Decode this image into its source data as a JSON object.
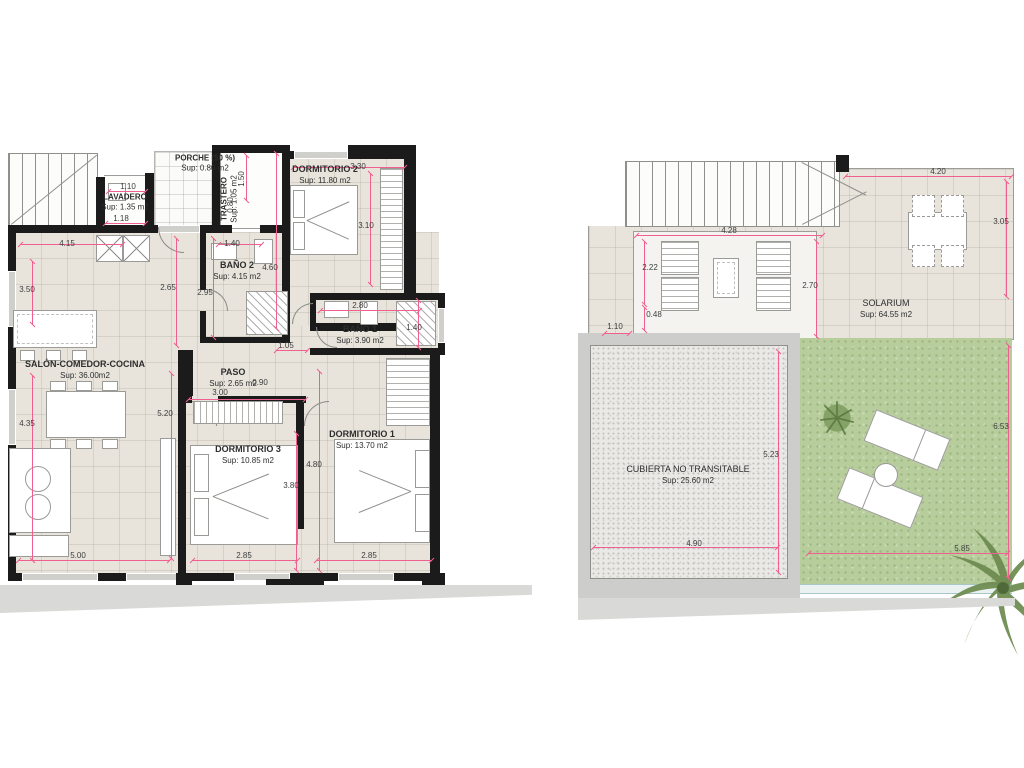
{
  "colors": {
    "accent_pink": "#ef5f90",
    "wall_black": "#1b1b1b",
    "floor_tile": "#e8e4dc",
    "grass_green": "#b7cd9c",
    "gravel_gray": "#eae9e5",
    "slab_gray": "#cdcdcb"
  },
  "left_plan": {
    "title": "apartment floor plan",
    "rooms": {
      "porche": {
        "label": "PORCHE (50 %)",
        "sup": "Sup: 0.80 m2"
      },
      "lavadero": {
        "label": "LAVADERO",
        "sup": "Sup: 1.35 m2"
      },
      "trastero": {
        "label": "TRASTERO",
        "sup": "Sup: 1.05 m2"
      },
      "dormitorio2": {
        "label": "DORMITORIO 2",
        "sup": "Sup: 11.80 m2"
      },
      "bano2": {
        "label": "BAÑO 2",
        "sup": "Sup: 4.15 m2"
      },
      "bano1": {
        "label": "BAÑO 1",
        "sup": "Sup: 3.90 m2"
      },
      "salon": {
        "label": "SALÓN-COMEDOR-COCINA",
        "sup": "Sup: 36.00m2"
      },
      "paso": {
        "label": "PASO",
        "sup": "Sup: 2.65 m2"
      },
      "dormitorio3": {
        "label": "DORMITORIO 3",
        "sup": "Sup: 10.85 m2"
      },
      "dormitorio1": {
        "label": "DORMITORIO 1",
        "sup": "Sup: 13.70 m2"
      }
    },
    "dims": {
      "d110": "1.10",
      "d118": "1.18",
      "d150": "1.50",
      "d080": "0.80",
      "d330": "3.30",
      "d310": "3.10",
      "d460": "4.60",
      "d415": "4.15",
      "d350": "3.50",
      "d265": "2.65",
      "d295": "2.95",
      "d140a": "1.40",
      "d280": "2.80",
      "d140b": "1.40",
      "d105": "1.05",
      "d090": "0.90",
      "d300": "3.00",
      "d435": "4.35",
      "d520": "5.20",
      "d380": "3.80",
      "d480": "4.80",
      "d500": "5.00",
      "d285a": "2.85",
      "d285b": "2.85"
    }
  },
  "right_plan": {
    "title": "roof terrace plan",
    "rooms": {
      "solarium": {
        "label": "SOLARIUM",
        "sup": "Sup: 64.55 m2"
      },
      "cubierta": {
        "label": "CUBIERTA NO TRANSITABLE",
        "sup": "Sup: 25.60 m2"
      }
    },
    "dims": {
      "d420": "4.20",
      "d305": "3.05",
      "d428": "4.28",
      "d222": "2.22",
      "d048": "0.48",
      "d270": "2.70",
      "d110": "1.10",
      "d523": "5.23",
      "d490": "4.90",
      "d653": "6.53",
      "d585": "5.85"
    }
  }
}
